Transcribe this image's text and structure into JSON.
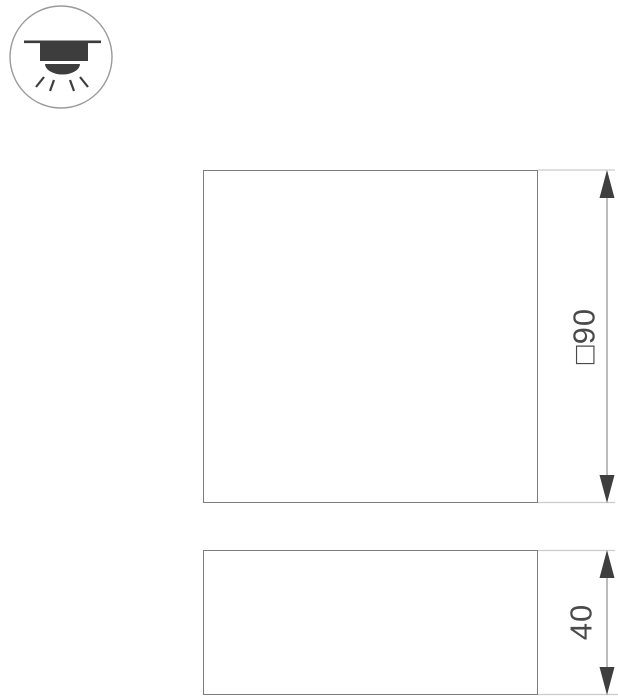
{
  "drawing": {
    "title": "luminaire-dimension-drawing",
    "icon": {
      "name": "surface-mounted-downlight",
      "description": "ceiling-mounted light shining downward"
    },
    "dimensions": {
      "front": {
        "label": "□90"
      },
      "side": {
        "label": "40"
      }
    },
    "colors": {
      "outline": "#7d7d7d",
      "extension_line": "#cccccc",
      "dimension_line": "#8f8f8f",
      "arrow": "#3f3f3f",
      "text": "#4a4a4a",
      "icon": "#3d3d3d"
    }
  }
}
